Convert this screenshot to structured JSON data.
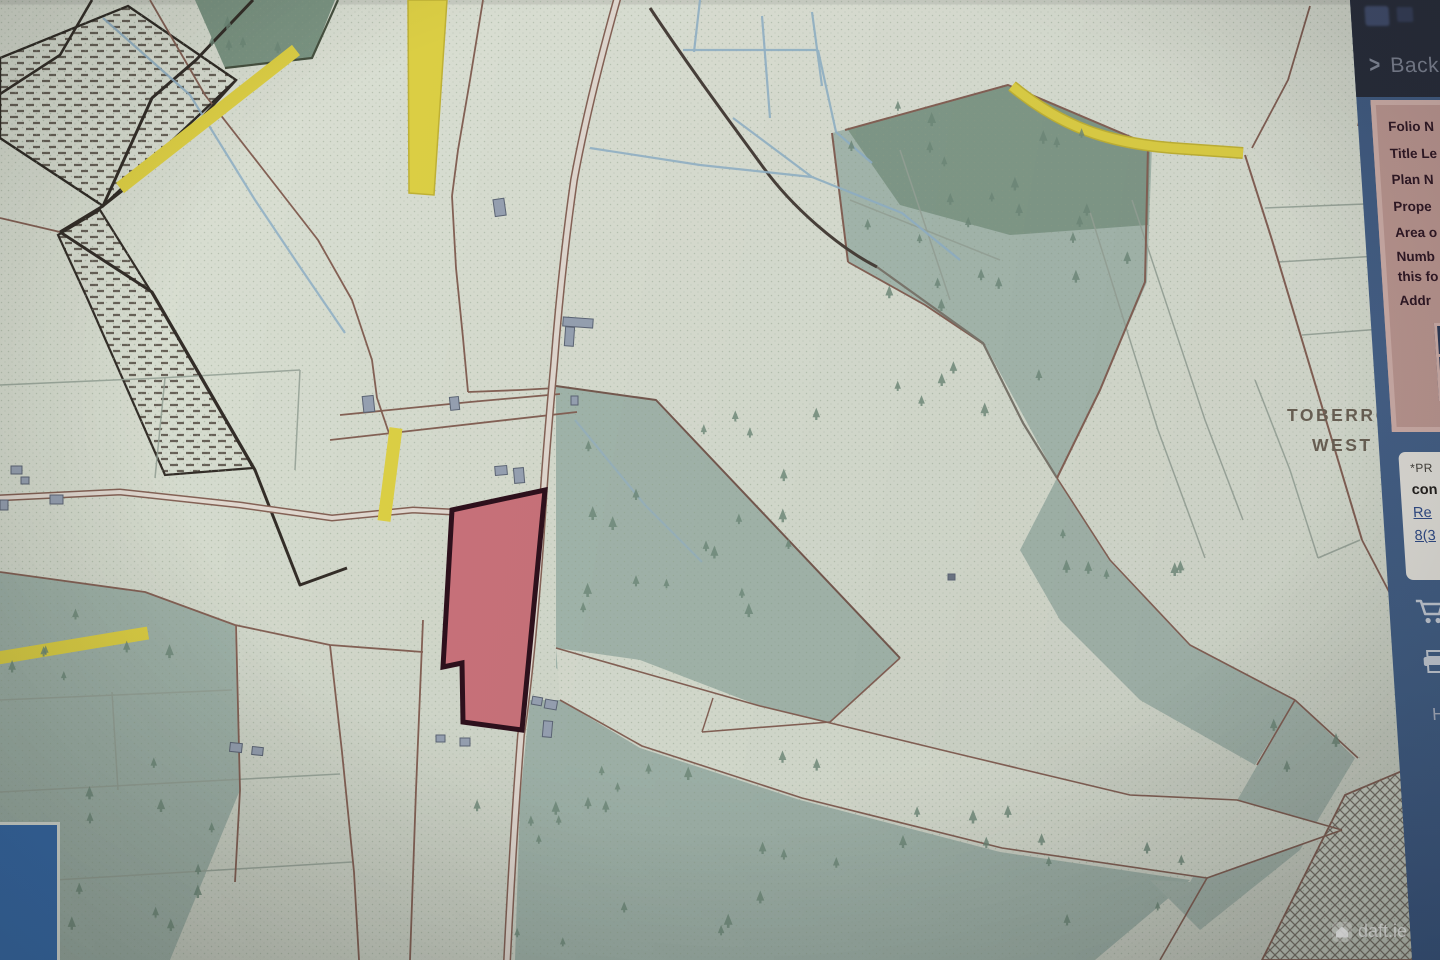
{
  "map": {
    "townland_label": {
      "line1": "TOBERROE",
      "line2": "WEST"
    },
    "watermark_brand": "daft.ie",
    "colors": {
      "highlighted_parcel": "#d5737c",
      "parcel_outline": "#2f0d1a",
      "road_yellow": "#e7d83a",
      "forest_teal": "#a9beb3",
      "forest_dark_green": "#7e9a86",
      "water_blue": "#94b7d0",
      "boundary_brown": "#8a6355"
    }
  },
  "sidebar": {
    "back_chevron": ">",
    "back_label": "Back",
    "folio_panel": {
      "rows": [
        "Folio N",
        "Title Le",
        "Plan N",
        "Prope",
        "Area o",
        "Numb",
        "this fo",
        "Addr"
      ]
    },
    "highlight_button_label": "Hig",
    "notice_panel": {
      "line1": "*PR",
      "line2": "con",
      "link1": "Re",
      "link2": "8(3"
    },
    "help_label": "He",
    "accent_colors": {
      "panel_pink": "#c49a93",
      "sidebar_blue": "#44638f",
      "button_navy": "#2b3a5b"
    }
  },
  "overlays": {
    "bottom_left_panel_color": "#2e63a4"
  }
}
